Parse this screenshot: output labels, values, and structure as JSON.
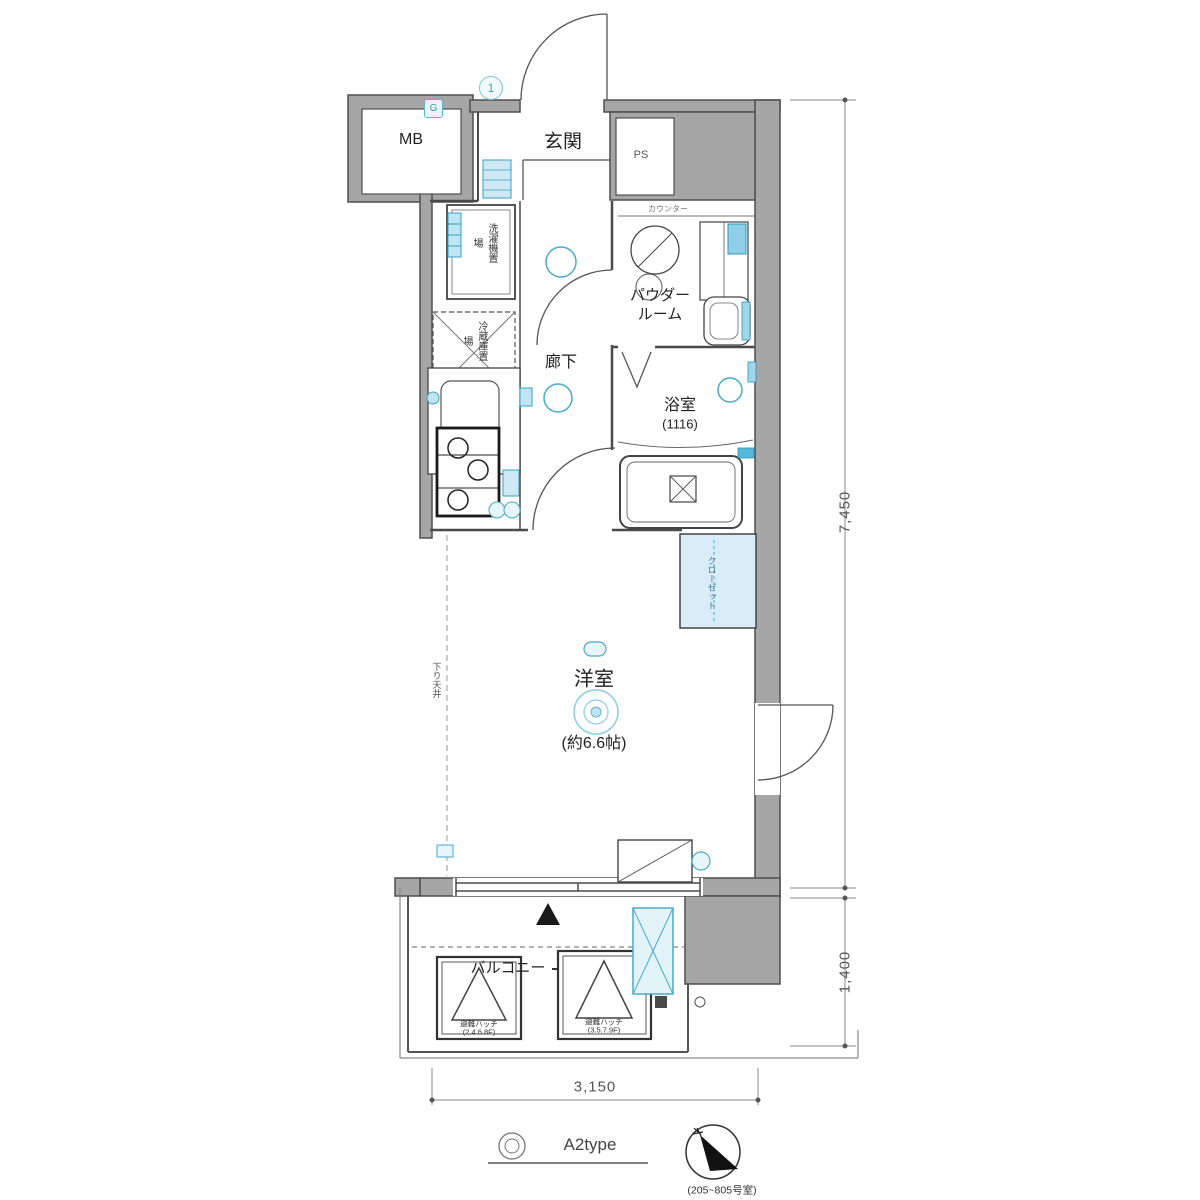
{
  "plan": {
    "labels": {
      "mb": "MB",
      "genkan": "玄関",
      "ps": "PS",
      "counter_note": "カウンター",
      "powder_room": "パウダー\nルーム",
      "hallway": "廊下",
      "bathroom": "浴室",
      "bathroom_size": "(1116)",
      "washer": "洗濯機置場",
      "fridge": "冷蔵庫置場",
      "closet": "クローゼット",
      "dropped_ceiling": "下り天井",
      "main_room": "洋室",
      "main_room_size": "(約6.6帖)",
      "balcony": "バルコニー"
    },
    "markers": {
      "door_number": "1",
      "gas": "G",
      "direction_triangle": "▲"
    },
    "hatch1": {
      "line1": "避難ハッチ",
      "line2": "(2.4.6.8F)"
    },
    "hatch2": {
      "line1": "避難ハッチ",
      "line2": "(3.5.7.9F)"
    },
    "dimensions": {
      "right_upper": "7,450",
      "right_lower": "1,400",
      "bottom": "3,150"
    },
    "footer": {
      "type_label": "A2type",
      "compass_caption": "(205~805号室)"
    }
  },
  "colors": {
    "wall_fill": "#a6a6a6",
    "wall_edge": "#4f4f4f",
    "line": "#4a4a4a",
    "accent": "#49a9c9",
    "accent_light": "#cfe9f4",
    "closet_fill": "#d8edf7"
  }
}
